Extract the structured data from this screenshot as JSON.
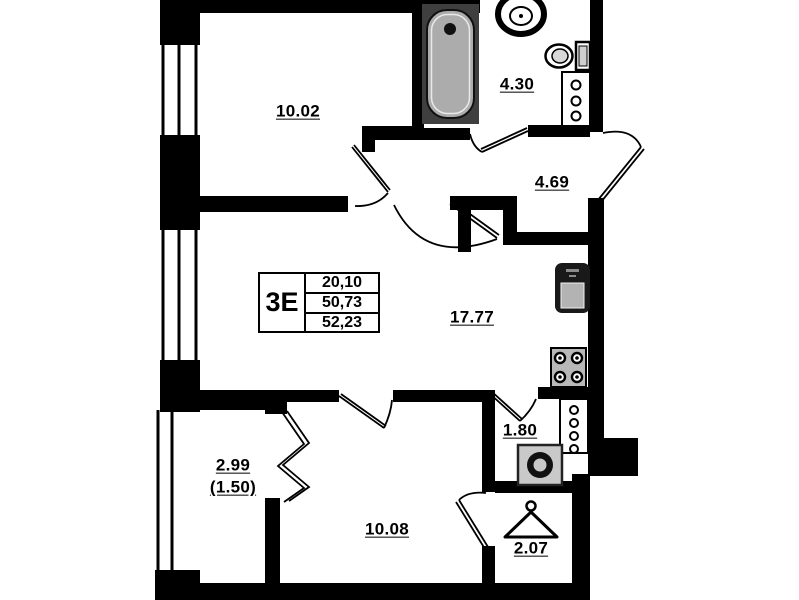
{
  "unit_info": {
    "type": "3Е",
    "areas": [
      "20,10",
      "50,73",
      "52,23"
    ]
  },
  "room_labels": {
    "bedroom_top": "10.02",
    "bathroom": "4.30",
    "hall": "4.69",
    "living_kitchen": "17.77",
    "corridor": "1.80",
    "balcony_area": "2.99",
    "balcony_reduced": "(1.50)",
    "bedroom_bottom": "10.08",
    "wardrobe": "2.07"
  },
  "fixtures": [
    "bathtub",
    "wash-basin",
    "toilet",
    "towel-riser",
    "kitchen-sink",
    "stove",
    "utility-riser",
    "washing-machine",
    "hanger"
  ],
  "colors": {
    "wall": "#000000",
    "tub_fill": "#acacac",
    "appliance_gray": "#c9c9c9",
    "background": "#ffffff"
  }
}
